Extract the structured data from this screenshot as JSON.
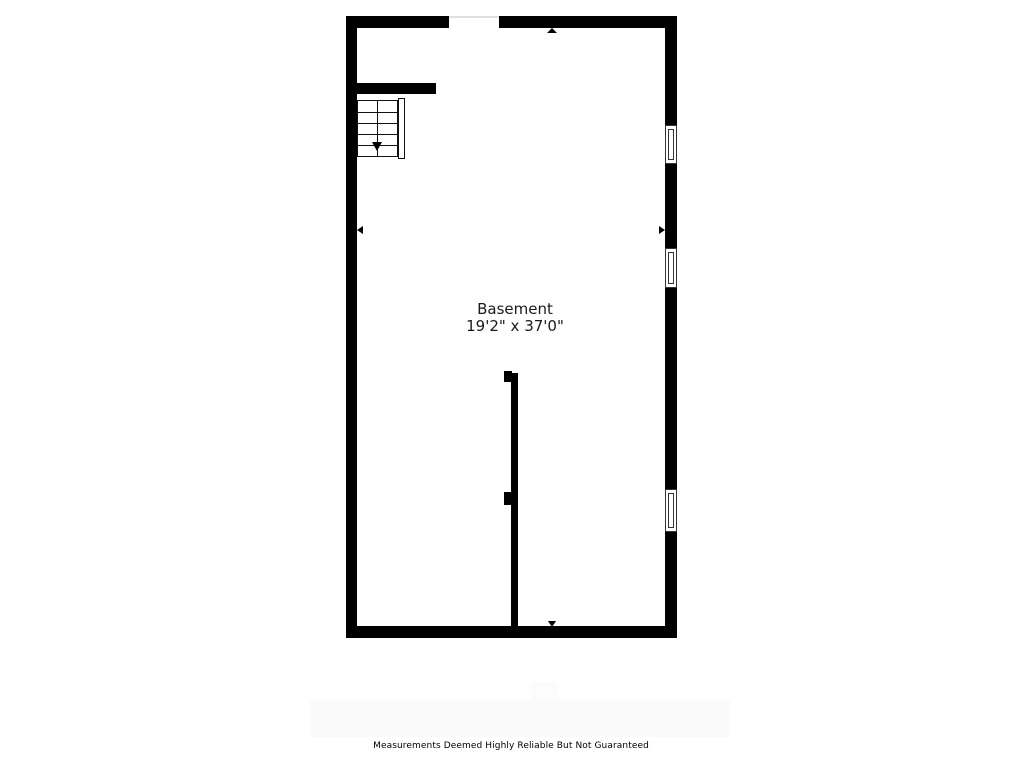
{
  "floorplan": {
    "room": {
      "name": "Basement",
      "size": "19'2\" x 37'0\""
    },
    "features": {
      "window_count": 3,
      "staircase_direction": "down"
    },
    "colors": {
      "wall": "#000000",
      "line": "#111111",
      "text": "#1a1a1a",
      "background": "#ffffff"
    }
  },
  "footer": {
    "disclaimer": "Measurements Deemed Highly Reliable But Not Guaranteed"
  }
}
